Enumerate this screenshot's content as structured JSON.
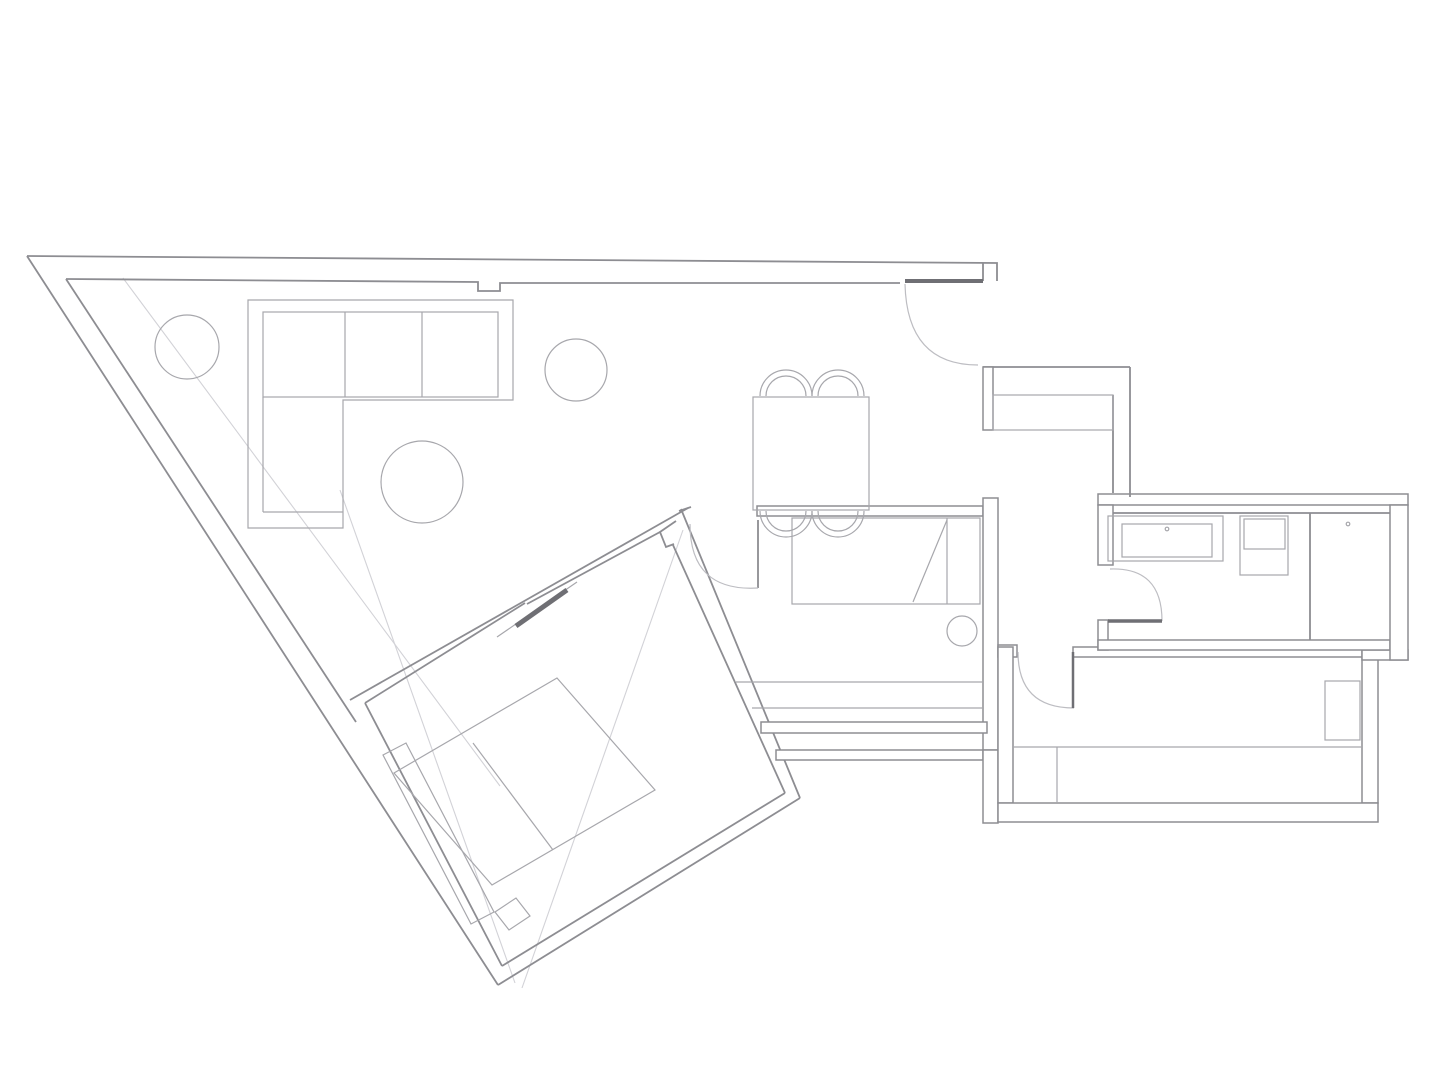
{
  "meta": {
    "kind": "apartment-floor-plan-drawing",
    "canvas": {
      "w": 1440,
      "h": 1080,
      "bg": "#ffffff"
    }
  },
  "colors": {
    "wall": "#8d8d92",
    "furniture": "#a7a7ac",
    "door_arc": "#bdbdc2",
    "dark": "#6f6f74",
    "faint": "#d2d2d7",
    "bg": "#ffffff"
  },
  "plan": {
    "items": [
      {
        "t": "p",
        "cls": "faint",
        "name": "crease-line-1",
        "d": "M123,278 L500,786"
      },
      {
        "t": "p",
        "cls": "faint",
        "name": "crease-line-2",
        "d": "M340,490 L515,983"
      },
      {
        "t": "p",
        "cls": "faint",
        "name": "crease-line-3",
        "d": "M683,530 L522,988"
      },
      {
        "t": "p",
        "cls": "wall",
        "name": "exterior-top-wall-outer",
        "d": "M27,256 L997,263 L997,281"
      },
      {
        "t": "p",
        "cls": "wall",
        "name": "exterior-top-wall-inner",
        "d": "M66,279 L478,282 L478,291 L500,291 L500,283 L900,283"
      },
      {
        "t": "p",
        "cls": "wall",
        "name": "entry-right-cap",
        "d": "M983,263 L983,281"
      },
      {
        "t": "p",
        "cls": "wall",
        "name": "exterior-left-wall-outer",
        "d": "M27,256 L498,985"
      },
      {
        "t": "p",
        "cls": "wall",
        "name": "exterior-left-wall-inner",
        "d": "M66,279 L356,722"
      },
      {
        "t": "p",
        "cls": "wall",
        "name": "bedroom3-ne-wall-outer",
        "d": "M681,509 L800,798"
      },
      {
        "t": "p",
        "cls": "wall",
        "name": "bedroom3-ne-wall-inner",
        "d": "M673,545 L785,793"
      },
      {
        "t": "p",
        "cls": "wall",
        "name": "bedroom3-nw-wall-outer",
        "d": "M688,508 L350,700"
      },
      {
        "t": "p",
        "cls": "wall",
        "name": "bedroom3-nw-wall-inner-lower",
        "d": "M365,703 L525,603"
      },
      {
        "t": "p",
        "cls": "wall",
        "name": "bedroom3-nw-wall-face",
        "d": "M660,532 L527,604"
      },
      {
        "t": "p",
        "cls": "wall",
        "name": "bedroom3-corner-cap",
        "d": "M679,511 L691,507"
      },
      {
        "t": "p",
        "cls": "wall",
        "name": "bedroom3-door-notch",
        "d": "M676,521 L660,532 L666,547 L674,544"
      },
      {
        "t": "p",
        "cls": "wall",
        "name": "bedroom3-se-wall-outer",
        "d": "M800,798 L498,985"
      },
      {
        "t": "p",
        "cls": "wall",
        "name": "bedroom3-se-wall-inner",
        "d": "M785,793 L502,966"
      },
      {
        "t": "p",
        "cls": "wall",
        "name": "bedroom3-sw-wall-inner",
        "d": "M365,703 L502,966"
      },
      {
        "t": "r",
        "cls": "band",
        "name": "bedroom2-top-wall",
        "x": 757,
        "y": 506,
        "w": 226,
        "h": 10
      },
      {
        "t": "p",
        "cls": "wall",
        "name": "bedroom2-door-leaf",
        "d": "M758,520 L758,588"
      },
      {
        "t": "r",
        "cls": "band",
        "name": "bedroom2-right-wall",
        "x": 983,
        "y": 498,
        "w": 15,
        "h": 252
      },
      {
        "t": "r",
        "cls": "band",
        "name": "bedroom2-bottom-wall",
        "x": 761,
        "y": 722,
        "w": 226,
        "h": 11
      },
      {
        "t": "r",
        "cls": "band",
        "name": "south-exterior-wall",
        "x": 776,
        "y": 750,
        "w": 207,
        "h": 10
      },
      {
        "t": "r",
        "cls": "band",
        "name": "south-exterior-corner",
        "x": 983,
        "y": 750,
        "w": 15,
        "h": 73
      },
      {
        "t": "r",
        "cls": "band",
        "name": "hall-door-stub",
        "x": 998,
        "y": 645,
        "w": 19,
        "h": 12
      },
      {
        "t": "r",
        "cls": "band",
        "name": "bedroom1-left-wall",
        "x": 998,
        "y": 647,
        "w": 15,
        "h": 156
      },
      {
        "t": "r",
        "cls": "band",
        "name": "bedroom1-top-wall",
        "x": 1073,
        "y": 647,
        "w": 289,
        "h": 10
      },
      {
        "t": "r",
        "cls": "band",
        "name": "bedroom1-right-wall",
        "x": 1362,
        "y": 657,
        "w": 16,
        "h": 146
      },
      {
        "t": "r",
        "cls": "band",
        "name": "bedroom1-right-step",
        "x": 1362,
        "y": 650,
        "w": 46,
        "h": 10
      },
      {
        "t": "r",
        "cls": "band",
        "name": "bedroom1-bottom-wall",
        "x": 998,
        "y": 803,
        "w": 380,
        "h": 19
      },
      {
        "t": "r",
        "cls": "band",
        "name": "bathroom-top-wall",
        "x": 1098,
        "y": 494,
        "w": 310,
        "h": 11
      },
      {
        "t": "r",
        "cls": "band",
        "name": "bathroom-left-wall",
        "x": 1098,
        "y": 505,
        "w": 15,
        "h": 60
      },
      {
        "t": "r",
        "cls": "band",
        "name": "bathroom-left-stub",
        "x": 1098,
        "y": 620,
        "w": 10,
        "h": 30
      },
      {
        "t": "r",
        "cls": "band",
        "name": "bathroom-bottom-wall",
        "x": 1098,
        "y": 640,
        "w": 292,
        "h": 10
      },
      {
        "t": "r",
        "cls": "band",
        "name": "bathroom-right-wall",
        "x": 1390,
        "y": 505,
        "w": 18,
        "h": 155
      },
      {
        "t": "p",
        "cls": "wall",
        "name": "bathroom-inner-face",
        "d": "M1113,513 L1390,513"
      },
      {
        "t": "p",
        "cls": "wall",
        "name": "bathroom-divider",
        "d": "M1310,513 L1310,640"
      },
      {
        "t": "p",
        "cls": "wall",
        "name": "entry-closet-top-wall",
        "d": "M983,367 L1130,367"
      },
      {
        "t": "r",
        "cls": "band",
        "name": "entry-closet-left-wall",
        "x": 983,
        "y": 367,
        "w": 10,
        "h": 63
      },
      {
        "t": "p",
        "cls": "wall",
        "name": "entry-closet-right-wall-outer",
        "d": "M1130,367 L1130,497"
      },
      {
        "t": "p",
        "cls": "wall",
        "name": "entry-closet-right-wall-inner",
        "d": "M1113,395 L1113,493"
      },
      {
        "t": "r",
        "cls": "furn",
        "name": "entry-closet-body",
        "x": 993,
        "y": 395,
        "w": 120,
        "h": 35
      },
      {
        "t": "p",
        "cls": "furn",
        "name": "sofa-outline",
        "d": "M248,300 L513,300 L513,400 L343,400 L343,528 L248,528 Z"
      },
      {
        "t": "r",
        "cls": "furn",
        "name": "sofa-seat",
        "x": 263,
        "y": 312,
        "w": 235,
        "h": 85
      },
      {
        "t": "p",
        "cls": "furn",
        "name": "sofa-cushion-line-1",
        "d": "M345,312 L345,397"
      },
      {
        "t": "p",
        "cls": "furn",
        "name": "sofa-cushion-line-2",
        "d": "M422,312 L422,397"
      },
      {
        "t": "p",
        "cls": "furn",
        "name": "sofa-chaise-line-1",
        "d": "M263,397 L263,512"
      },
      {
        "t": "p",
        "cls": "furn",
        "name": "sofa-chaise-line-2",
        "d": "M263,512 L343,512"
      },
      {
        "t": "c",
        "cls": "furn",
        "name": "plant-circle-left",
        "cx": 187,
        "cy": 347,
        "r": 32
      },
      {
        "t": "c",
        "cls": "furn",
        "name": "plant-circle-top",
        "cx": 576,
        "cy": 370,
        "r": 31
      },
      {
        "t": "c",
        "cls": "furn",
        "name": "coffee-table",
        "cx": 422,
        "cy": 482,
        "r": 41
      },
      {
        "t": "r",
        "cls": "furn",
        "name": "dining-table",
        "x": 753,
        "y": 397,
        "w": 116,
        "h": 113
      },
      {
        "t": "p",
        "cls": "furn",
        "name": "dining-chair-top-1",
        "d": "M760,396 A26,26 0 0 1 812,396 M766,396 A20,20 0 0 1 806,396"
      },
      {
        "t": "p",
        "cls": "furn",
        "name": "dining-chair-top-2",
        "d": "M812,396 A26,26 0 0 1 864,396 M818,396 A20,20 0 0 1 858,396"
      },
      {
        "t": "p",
        "cls": "furn",
        "name": "dining-chair-bottom-1",
        "d": "M760,511 A26,26 0 0 0 812,511 M766,511 A20,20 0 0 0 806,511"
      },
      {
        "t": "p",
        "cls": "furn",
        "name": "dining-chair-bottom-2",
        "d": "M812,511 A26,26 0 0 0 864,511 M818,511 A20,20 0 0 0 858,511"
      },
      {
        "t": "r",
        "cls": "furn",
        "name": "bedroom2-bed",
        "x": 792,
        "y": 518,
        "w": 188,
        "h": 86
      },
      {
        "t": "p",
        "cls": "furn",
        "name": "bedroom2-bed-pillow-line",
        "d": "M947,518 L947,604"
      },
      {
        "t": "p",
        "cls": "furn",
        "name": "bedroom2-bed-fold-line",
        "d": "M947,520 L913,602"
      },
      {
        "t": "c",
        "cls": "furn",
        "name": "bedroom2-stool",
        "cx": 962,
        "cy": 631,
        "r": 15
      },
      {
        "t": "p",
        "cls": "furn",
        "name": "bedroom2-shelf-line-1",
        "d": "M736,682 L983,682"
      },
      {
        "t": "p",
        "cls": "furn",
        "name": "bedroom2-shelf-line-2",
        "d": "M752,708 L983,708"
      },
      {
        "t": "g",
        "cls": "furn",
        "name": "bedroom3-bed",
        "pts": "557,678 655,790 492,885 394,773"
      },
      {
        "t": "p",
        "cls": "furn",
        "name": "bedroom3-bed-fold-line",
        "d": "M473,743 L553,850"
      },
      {
        "t": "g",
        "cls": "furn",
        "name": "bedroom3-wardrobe",
        "pts": "383,755 406,743 494,912 471,924"
      },
      {
        "t": "g",
        "cls": "furn",
        "name": "bedroom3-bench",
        "pts": "495,912 516,898 530,916 509,930"
      },
      {
        "t": "p",
        "cls": "furn",
        "name": "bedroom3-door-leaf-outline",
        "d": "M497,637 L577,582"
      },
      {
        "t": "r",
        "cls": "furn",
        "name": "bedroom1-nightstand",
        "x": 1325,
        "y": 681,
        "w": 35,
        "h": 59
      },
      {
        "t": "p",
        "cls": "furn",
        "name": "bedroom1-wardrobe-top",
        "d": "M1013,747 L1362,747"
      },
      {
        "t": "p",
        "cls": "furn",
        "name": "bedroom1-wardrobe-divider",
        "d": "M1057,747 L1057,803"
      },
      {
        "t": "r",
        "cls": "furn",
        "name": "bathroom-vanity",
        "x": 1108,
        "y": 516,
        "w": 115,
        "h": 45
      },
      {
        "t": "r",
        "cls": "furn",
        "name": "bathroom-sink",
        "x": 1122,
        "y": 524,
        "w": 90,
        "h": 33
      },
      {
        "t": "c",
        "cls": "furn",
        "name": "bathroom-faucet-dot",
        "cx": 1167,
        "cy": 529,
        "r": 1.8
      },
      {
        "t": "r",
        "cls": "furn",
        "name": "bathroom-washer",
        "x": 1240,
        "y": 516,
        "w": 48,
        "h": 59
      },
      {
        "t": "r",
        "cls": "furn",
        "name": "bathroom-washer-inner",
        "x": 1244,
        "y": 519,
        "w": 41,
        "h": 30
      },
      {
        "t": "c",
        "cls": "furn",
        "name": "bathroom-shower-dot",
        "cx": 1348,
        "cy": 524,
        "r": 1.8
      },
      {
        "t": "p",
        "cls": "door",
        "name": "entry-door-arc",
        "d": "M905,284 Q907,365 978,365"
      },
      {
        "t": "p",
        "cls": "door",
        "name": "bedroom2-door-arc",
        "d": "M690,524 Q690,592 758,588"
      },
      {
        "t": "p",
        "cls": "door",
        "name": "bedroom1-door-arc",
        "d": "M1018,652 Q1018,708 1074,708"
      },
      {
        "t": "p",
        "cls": "door",
        "name": "bathroom-door-arc",
        "d": "M1110,569 Q1162,567 1162,621"
      },
      {
        "t": "l",
        "cls": "dark",
        "name": "entry-threshold",
        "x1": 905,
        "y1": 281,
        "x2": 983,
        "y2": 281,
        "sw": 4
      },
      {
        "t": "l",
        "cls": "dark",
        "name": "bedroom3-sliding-door",
        "x1": 516,
        "y1": 626,
        "x2": 567,
        "y2": 590,
        "sw": 5
      },
      {
        "t": "l",
        "cls": "dark",
        "name": "bathroom-door-leaf",
        "x1": 1108,
        "y1": 621,
        "x2": 1162,
        "y2": 621,
        "sw": 3.5
      },
      {
        "t": "l",
        "cls": "dark",
        "name": "bedroom1-door-leaf",
        "x1": 1073,
        "y1": 652,
        "x2": 1073,
        "y2": 708,
        "sw": 2.5
      }
    ]
  }
}
